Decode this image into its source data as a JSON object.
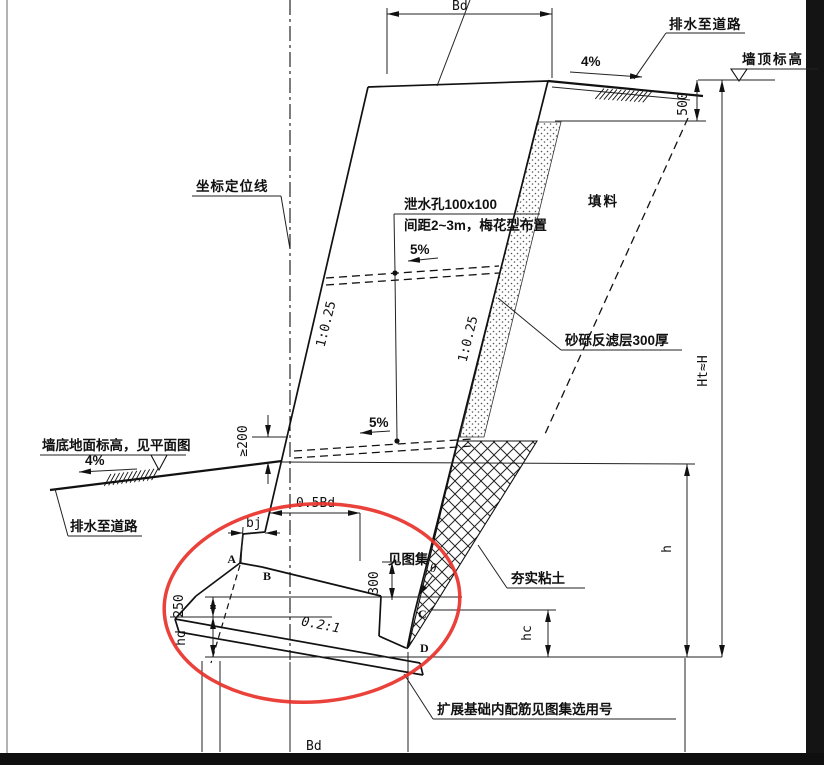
{
  "drawing_title": "挡土墙横断面图 (retaining wall cross-section)",
  "colors": {
    "line": "#111111",
    "highlight_ellipse": "#e8312a",
    "frame_bar": "#141414"
  },
  "labels": {
    "bd_top": "Bd",
    "drain_top_right": "排水至道路",
    "slope_4_top": "4%",
    "wall_top_elev": "墙顶标高",
    "dim_500": "500",
    "coord_position_line": "坐标定位线",
    "weep_hole_title": "泄水孔100x100",
    "weep_hole_spacing": "间距2~3m，梅花型布置",
    "slope_5_upper": "5%",
    "slope_5_lower": "5%",
    "fill_material": "填料",
    "batter_left": "1:0.25",
    "batter_right": "1:0.25",
    "filter_layer": "砂砾反滤层300厚",
    "ht_h": "Ht≈H",
    "wall_bottom_elev": "墙底地面标高，见平面图",
    "slope_4_left": "4%",
    "ge_200": "≥200",
    "drain_bottom_left": "排水至道路",
    "dim_05bd": "0.5Bd",
    "dim_bj": "bj",
    "pt_a": "A",
    "pt_b": "B",
    "pt_c": "C",
    "pt_d": "D",
    "dim_300": "300",
    "see_atlas": "见图集",
    "theta": "θ",
    "compacted_clay": "夯实粘土",
    "footing_slope": "0.2:1",
    "dim_250": "250",
    "dim_hd": "hd",
    "dim_hc": "hc",
    "dim_h": "h",
    "footing_note": "扩展基础内配筋见图集选用号",
    "bd_bottom": "Bd"
  }
}
